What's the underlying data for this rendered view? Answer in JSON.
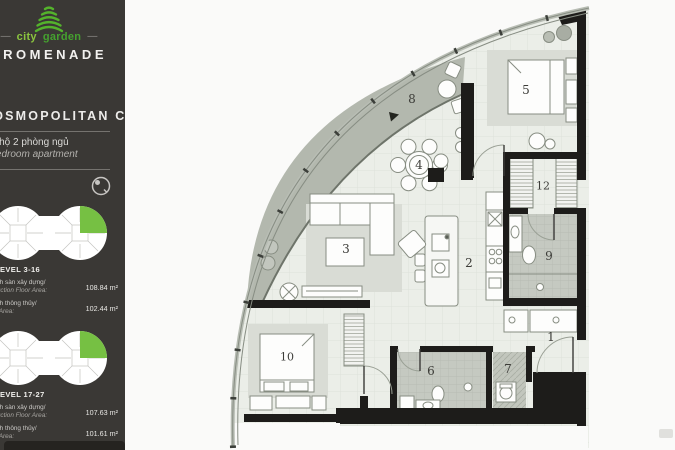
{
  "brand": {
    "logo_city": "city",
    "logo_garden": "garden",
    "logo_dash": "—",
    "name": "PROMENADE"
  },
  "unit": {
    "title": "COSMOPOLITAN C",
    "type_vi": "Căn hộ 2 phòng ngủ",
    "type_en": "2 bedroom apartment"
  },
  "sections": [
    {
      "level": "LEVEL 3-16",
      "rows": [
        {
          "label_vi": "Diện tích sàn xây dựng/",
          "label_en": "Construction Floor Area:",
          "value": "108.84 m²"
        },
        {
          "label_vi": "Diện tích thông thủy/",
          "label_en": "Carpet Area:",
          "value": "102.44 m²"
        }
      ]
    },
    {
      "level": "LEVEL 17-27",
      "rows": [
        {
          "label_vi": "Diện tích sàn xây dựng/",
          "label_en": "Construction Floor Area:",
          "value": "107.63 m²"
        },
        {
          "label_vi": "Diện tích thông thủy/",
          "label_en": "Carpet Area:",
          "value": "101.61 m²"
        }
      ]
    }
  ],
  "floorplan": {
    "labels": [
      {
        "n": "1"
      },
      {
        "n": "2"
      },
      {
        "n": "3"
      },
      {
        "n": "4"
      },
      {
        "n": "5"
      },
      {
        "n": "6"
      },
      {
        "n": "7"
      },
      {
        "n": "8"
      },
      {
        "n": "9"
      },
      {
        "n": "10"
      },
      {
        "n": "12"
      }
    ]
  },
  "colors": {
    "accent_green": "#76c043",
    "logo_green": "#54b32c",
    "sidebar_bg": "#3a3835",
    "wall_black": "#1d1c1a",
    "balcony_gray": "#b3b8ae",
    "floor_light": "#ebeee8",
    "wet_room_gray": "#c5c9c1"
  }
}
